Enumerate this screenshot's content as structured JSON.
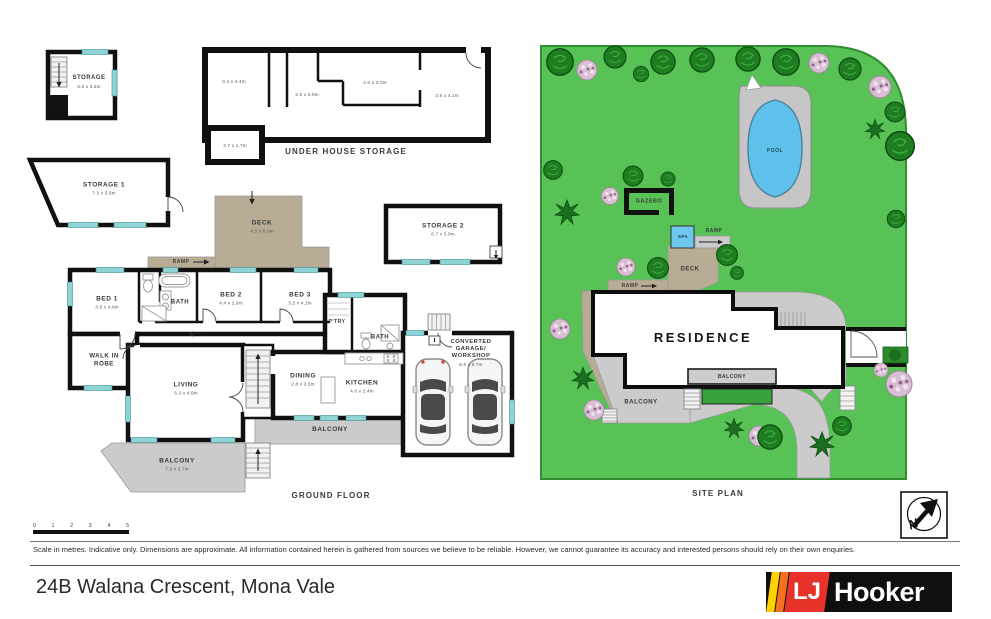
{
  "fp": {
    "title": "GROUND FLOOR",
    "under_house_title": "UNDER HOUSE STORAGE",
    "storage_upper": {
      "name": "STORAGE",
      "dims": "3.6 x 3.4m"
    },
    "storage1": {
      "name": "STORAGE 1",
      "dims": "7.3 x 3.6m"
    },
    "storage2": {
      "name": "STORAGE 2",
      "dims": "6.7 x 3.0m"
    },
    "uhs_dims": [
      "3.4 x 4.4m",
      "2.5 x 3.0m",
      "4.0 x 3.0m",
      "3.5 x 4.1m",
      "2.7 x 1.7m"
    ],
    "deck": {
      "name": "DECK",
      "dims": "4.5 x 6.0m"
    },
    "ramp": "RAMP",
    "bed1": {
      "name": "BED 1",
      "dims": "3.5 x 4.0m"
    },
    "bed2": {
      "name": "BED 2",
      "dims": "4.4 x 2.9m"
    },
    "bed3": {
      "name": "BED 3",
      "dims": "3.2 x 4.1m"
    },
    "bath1": "BATH",
    "bath2": "BATH",
    "pantry": "P'TRY",
    "walk_in_robe": "WALK IN ROBE",
    "living": {
      "name": "LIVING",
      "dims": "6.3 x 4.9m"
    },
    "dining": {
      "name": "DINING",
      "dims": "2.8 x 3.5m"
    },
    "kitchen": {
      "name": "KITCHEN",
      "dims": "4.0 x 2.4m"
    },
    "garage": {
      "name": "CONVERTED GARAGE/ WORKSHOP",
      "dims": "6.6 x 5.7m"
    },
    "balcony_rear": "BALCONY",
    "balcony_front": {
      "name": "BALCONY",
      "dims": "7.9 x 3.7m"
    }
  },
  "sp": {
    "title": "SITE PLAN",
    "pool": "POOL",
    "gazebo": "GAZEBO",
    "spa": "SPA",
    "ramp_upper": "RAMP",
    "ramp_lower": "RAMP",
    "deck": "DECK",
    "residence": "RESIDENCE",
    "balcony_upper": "BALCONY",
    "balcony_lower": "BALCONY"
  },
  "scalebar": {
    "ticks": [
      "0",
      "1",
      "2",
      "3",
      "4",
      "5"
    ]
  },
  "footer": {
    "disclaimer": "Scale in metres. Indicative only. Dimensions are approximate. All information contained herein is gathered from sources we believe to be reliable. However, we cannot guarantee its accuracy and interested persons should rely on their own enquiries.",
    "address": "24B Walana Crescent, Mona Vale"
  },
  "brand": {
    "lj": "LJ",
    "name": "Hooker"
  },
  "compass": {
    "n": "N"
  },
  "colors": {
    "grass": "#58c257",
    "grass_border": "#2f8e2f",
    "deck_tan": "#b8ac95",
    "paving_grey": "#cbcbcb",
    "window_teal": "#8ed4d6",
    "pool_blue": "#5fc1e9",
    "planter_green": "#3aa23a",
    "wall_black": "#111111",
    "brand_yellow": "#ffd200",
    "brand_orange": "#f4711f",
    "brand_red": "#e63229",
    "brand_black": "#0f0f0f"
  }
}
